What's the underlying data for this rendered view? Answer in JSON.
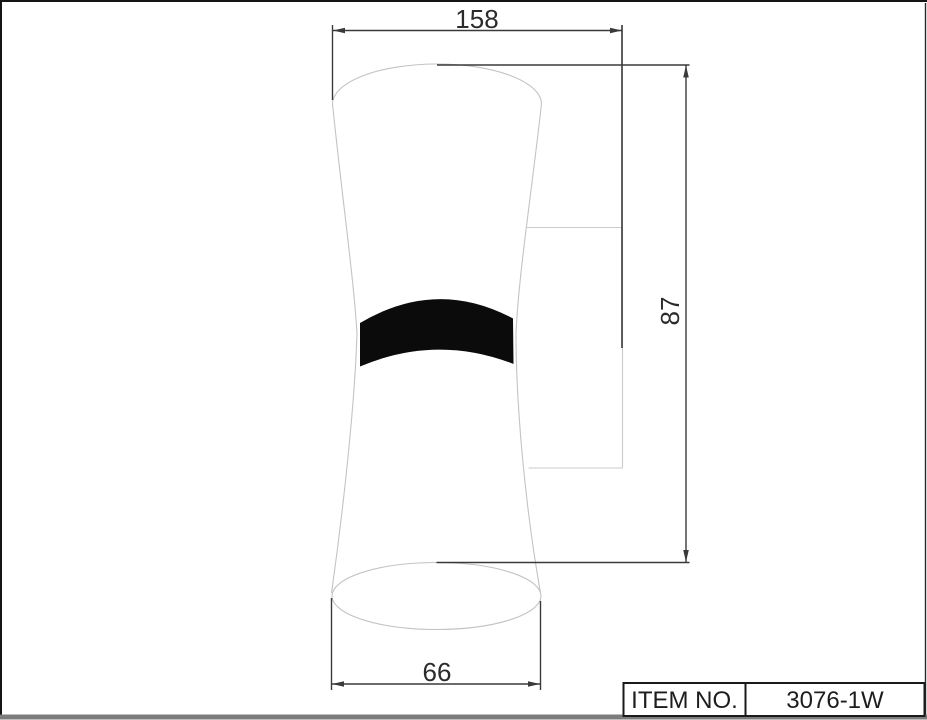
{
  "drawing": {
    "type": "technical-dimension-drawing",
    "subject": "wall lamp, hourglass shaped shade with wall mount bracket, side view",
    "dimensions": {
      "width_top": "158",
      "height": "87",
      "width_bottom": "66"
    },
    "title_block": {
      "item_label": "ITEM NO.",
      "item_value": "3076-1W"
    },
    "colors": {
      "background": "#ffffff",
      "dimension_lines": "#3a3a3a",
      "lamp_outline": "#c3c3c3",
      "bracket_outline": "#cbcbcb",
      "band_fill": "#0b0b0b",
      "frame_border": "#141414",
      "bottom_bar": "#7c7c7c"
    }
  }
}
